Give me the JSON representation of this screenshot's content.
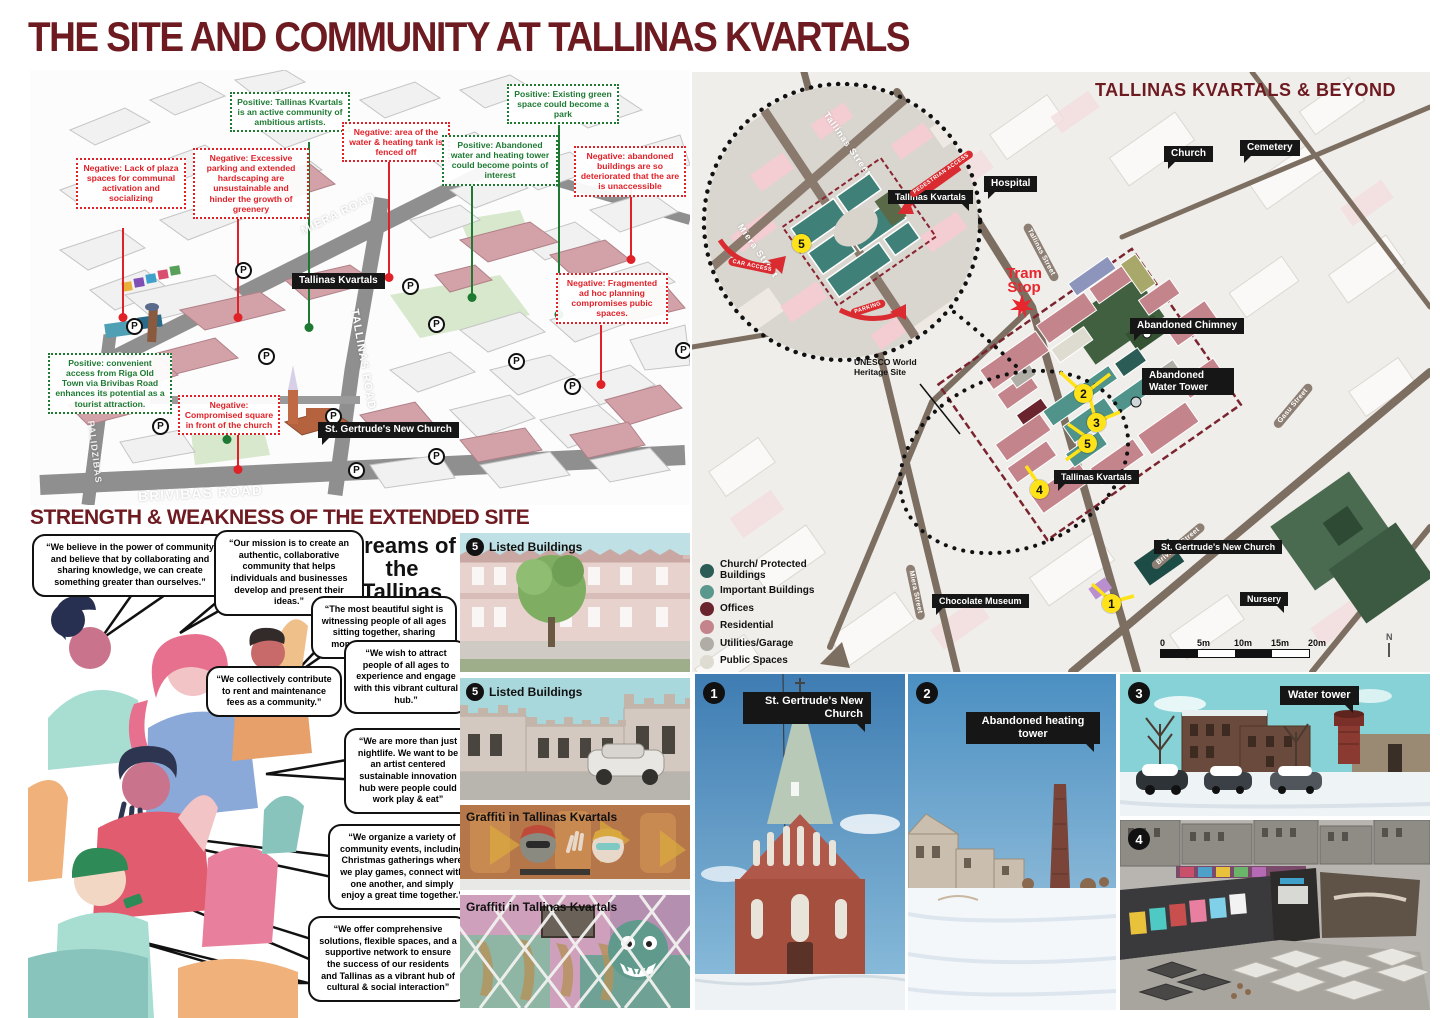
{
  "page": {
    "title": "THE SITE AND COMMUNITY AT TALLINAS KVARTALS"
  },
  "strength_heading": "STRENGTH & WEAKNESS OF THE EXTENDED SITE",
  "axon_map": {
    "callouts": [
      {
        "type": "negative",
        "text": "Negative: Lack of plaza spaces for communal activation and socializing"
      },
      {
        "type": "negative",
        "text": "Negative: Excessive parking and extended hardscaping are unsustainable and hinder the growth of greenery"
      },
      {
        "type": "positive",
        "text": "Positive: Tallinas Kvartals is an active community of ambitious artists."
      },
      {
        "type": "negative",
        "text": "Negative: area of the water & heating tank is fenced off"
      },
      {
        "type": "positive",
        "text": "Positive: Abandoned water and heating tower could become points of interest"
      },
      {
        "type": "positive",
        "text": "Positive: Existing green space could become a park"
      },
      {
        "type": "negative",
        "text": "Negative: abandoned buildings are so deteriorated that the are is unaccessible"
      },
      {
        "type": "negative",
        "text": "Negative: Fragmented ad hoc planning compromises pubic spaces."
      },
      {
        "type": "positive",
        "text": "Positive: convenient access from Riga Old Town via Brivibas Road enhances its potential as a tourist attraction."
      },
      {
        "type": "negative",
        "text": "Negative: Compromised square in front of the church"
      }
    ],
    "labels": {
      "site": "Tallinas Kvartals",
      "church": "St. Gertrude's New Church"
    },
    "roads": [
      "MIERA ROAD",
      "TALLINAS ROAD",
      "BRIVIBAS ROAD",
      "PALIDZIBAS"
    ],
    "parking_symbol": "P"
  },
  "dreams": {
    "title": "Dreams of the Tallinas Kvartals",
    "bubbles": [
      "“We believe in the power of community and believe that by collaborating and sharing knowledge, we can create something greater than ourselves.”",
      "“Our mission is to create an authentic, collaborative community that helps individuals and businesses develop and present their ideas.”",
      "“The most beautiful sight is witnessing people of all ages sitting together, sharing moments at our events.”",
      "“We wish to attract people of all ages to experience and engage with this vibrant cultural hub.”",
      "“We collectively contribute to rent and maintenance fees as a community.”",
      "“We are more than just nightlife. We want to be an artist centered sustainable innovation hub were people could work play & eat”",
      "“We organize a variety of community events, including Christmas gatherings where we play games, connect with one another, and simply enjoy a great time together.”",
      "“We offer comprehensive solutions, flexible spaces, and a supportive network to ensure the success of our residents and Tallinas as a vibrant hub of cultural & social interaction”"
    ]
  },
  "photo_column": {
    "items": [
      {
        "badge": "5",
        "label": "Listed Buildings"
      },
      {
        "badge": "5",
        "label": "Listed Buildings"
      },
      {
        "label": "Graffiti in Tallinas Kvartals"
      },
      {
        "label": "Graffiti in Tallinas Kvartals"
      }
    ]
  },
  "beyond_map": {
    "title": "TALLINAS KVARTALS & BEYOND",
    "labels": {
      "church": "Church",
      "cemetery": "Cemetery",
      "hospital": "Hospital",
      "abandoned_chimney": "Abandoned Chimney",
      "abandoned_water_tower": "Abandoned Water Tower",
      "tallinas_kvartals": "Tallinas Kvartals",
      "chocolate_museum": "Chocolate Museum",
      "st_gertrudes": "St. Gertrude's New Church",
      "nursery": "Nursery"
    },
    "tram_stop": "Tram Stop",
    "unesco": "UNESCO World Heritage Site",
    "inset": {
      "streets": [
        "Miera Street",
        "Tallinas Street"
      ],
      "arrows": [
        "CAR ACCESS",
        "PEDESTRIAN ACCESS",
        "PARKING"
      ],
      "label": "Tallinas Kvartals",
      "marker": "5"
    },
    "streets": [
      "Tallinas Street",
      "Miera Street",
      "Brivibas Street",
      "Gasu Street"
    ],
    "markers": [
      "1",
      "2",
      "3",
      "4",
      "5"
    ],
    "legend": [
      {
        "color": "#2b5c55",
        "label": "Church/ Protected Buildings"
      },
      {
        "color": "#5a978c",
        "label": "Important Buildings"
      },
      {
        "color": "#69242e",
        "label": "Offices"
      },
      {
        "color": "#c4848c",
        "label": "Residential"
      },
      {
        "color": "#b0aca6",
        "label": "Utilities/Garage"
      },
      {
        "color": "#dedbd0",
        "label": "Public Spaces"
      },
      {
        "color": "#46684a",
        "label": "Green Zone"
      }
    ],
    "scale": {
      "ticks": [
        "0",
        "5m",
        "10m",
        "15m",
        "20m"
      ],
      "north": "N"
    }
  },
  "photos": [
    {
      "badge": "1",
      "label": "St. Gertrude's New Church"
    },
    {
      "badge": "2",
      "label": "Abandoned heating tower"
    },
    {
      "badge": "3",
      "label": "Water tower"
    },
    {
      "badge": "4",
      "label": ""
    }
  ]
}
